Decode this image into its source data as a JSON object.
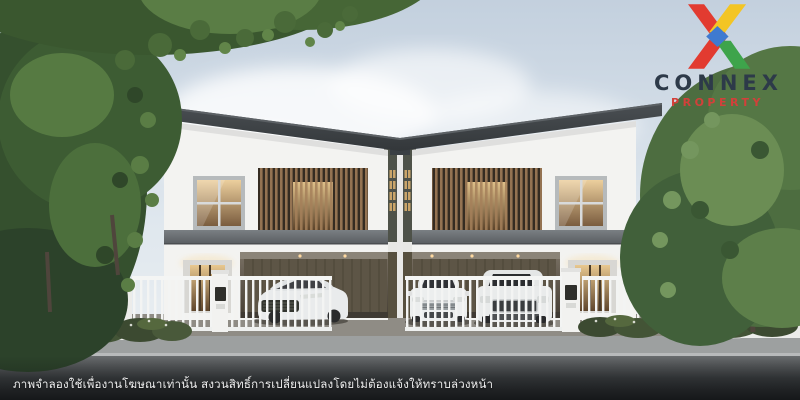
{
  "page": {
    "width": 800,
    "height": 400,
    "kind": "real-estate advertising render"
  },
  "logo": {
    "brand": "CONNEX",
    "sub_brand": "PROPERTY",
    "colors": {
      "brand_text": "#2d3a49",
      "sub_text": "#d2403a",
      "red": "#e23b30",
      "yellow": "#f3c524",
      "green": "#3ea44b",
      "blue": "#3f7ad0"
    }
  },
  "disclaimer": {
    "text": "ภาพจำลองใช้เพื่องานโฆษณาเท่านั้น สงวนสิทธิ์การเปลี่ยนแปลงโดยไม่ต้องแจ้งให้ทราบล่วงหน้า",
    "color": "#ffffff"
  },
  "scene": {
    "subject": "twin two-storey modern white townhouses with wood-louver balconies, carports with three white cars, white picket fence, garden trees and street",
    "palette": {
      "sky": "#c6d3e1",
      "roof": "#3c4145",
      "walls": "#f3f3f1",
      "wood_louver": "#a5805a",
      "window_glow": "#d9b683",
      "garage_panel": "#5d5546",
      "foliage_dark": "#35502e",
      "foliage_light": "#6b8d54",
      "fence": "#f3f4f3",
      "car": "#eceeee",
      "road": "#3c3f41",
      "sidewalk": "#9da0a0"
    }
  }
}
